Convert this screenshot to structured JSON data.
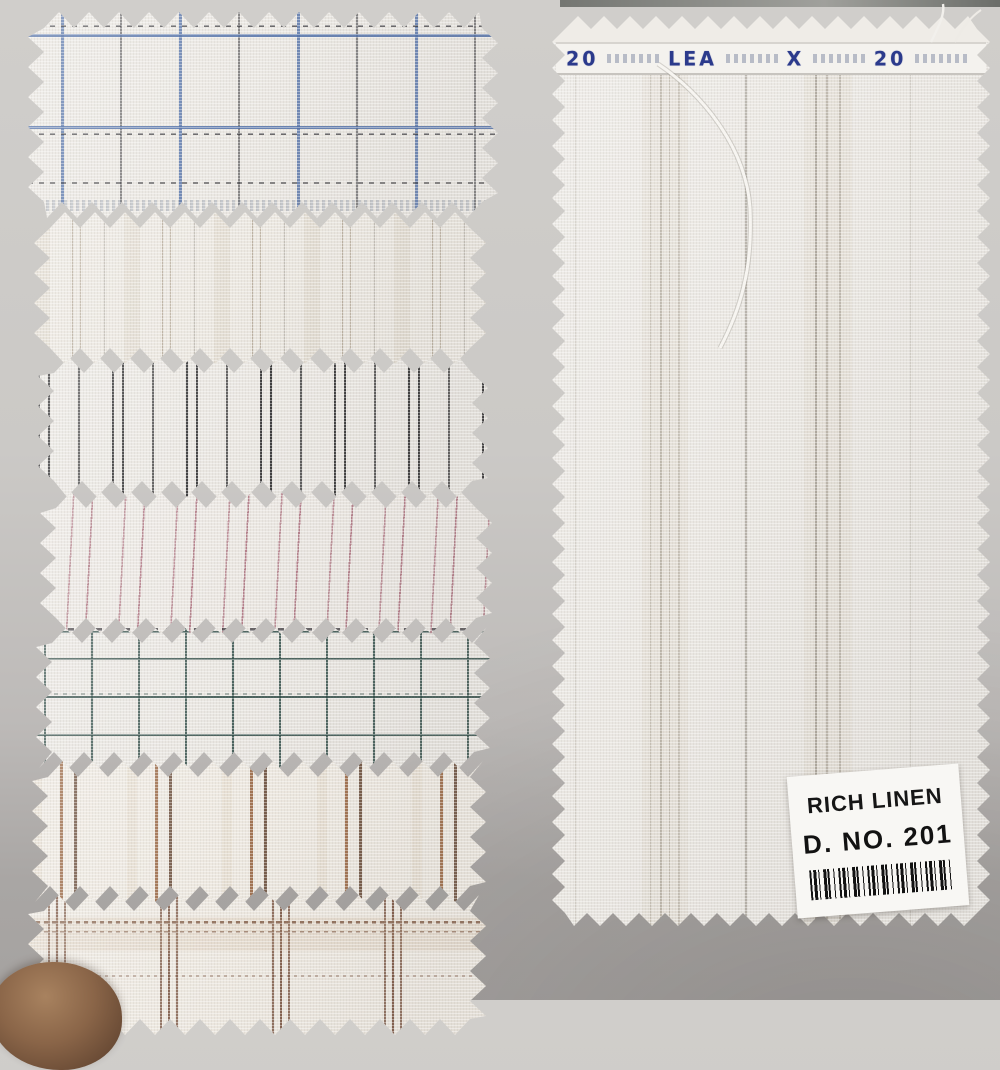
{
  "image_type": "photograph",
  "subject": "fabric sample card with pinked-edge linen swatches",
  "background_color": "#c9c6c3",
  "selvage_label": {
    "part1": "20",
    "part2": "LEA",
    "part3": "X",
    "part4": "20",
    "full_text": "20 LEA X 20",
    "text_color": "#2b3a8c"
  },
  "sticker": {
    "title": "RICH LINEN",
    "design_number": "D. NO. 201",
    "has_barcode": true,
    "background": "#f8f7f4",
    "text_color": "#141414"
  },
  "swatches": [
    {
      "position": 1,
      "pattern": "windowpane check",
      "colors": [
        "#5070aa",
        "#323237"
      ],
      "base": "#ebe8e3"
    },
    {
      "position": 2,
      "pattern": "grouped tan pin stripes",
      "colors": [
        "#94846e"
      ],
      "base": "#ece8e1"
    },
    {
      "position": 3,
      "pattern": "dotted black double stripes",
      "colors": [
        "#202022"
      ],
      "base": "#eae7e2"
    },
    {
      "position": 4,
      "pattern": "maroon pin stripes",
      "colors": [
        "#984a5e"
      ],
      "base": "#ebe7e2"
    },
    {
      "position": 5,
      "pattern": "teal grid check",
      "colors": [
        "#2f4c46"
      ],
      "base": "#e9e6e1"
    },
    {
      "position": 6,
      "pattern": "rust double stripes",
      "colors": [
        "#8e552d",
        "#583824"
      ],
      "base": "#ede8e0"
    },
    {
      "position": 7,
      "pattern": "brown tattersall plaid",
      "colors": [
        "#704834"
      ],
      "base": "#ece7df"
    }
  ],
  "main_panel": {
    "pattern": "vertical tan stripe clusters",
    "stripe_color": "#8c8578",
    "base": "#eae7e2"
  },
  "extras": {
    "loose_thread": "white thread on panel",
    "finger": "fingertip at bottom-left corner"
  }
}
